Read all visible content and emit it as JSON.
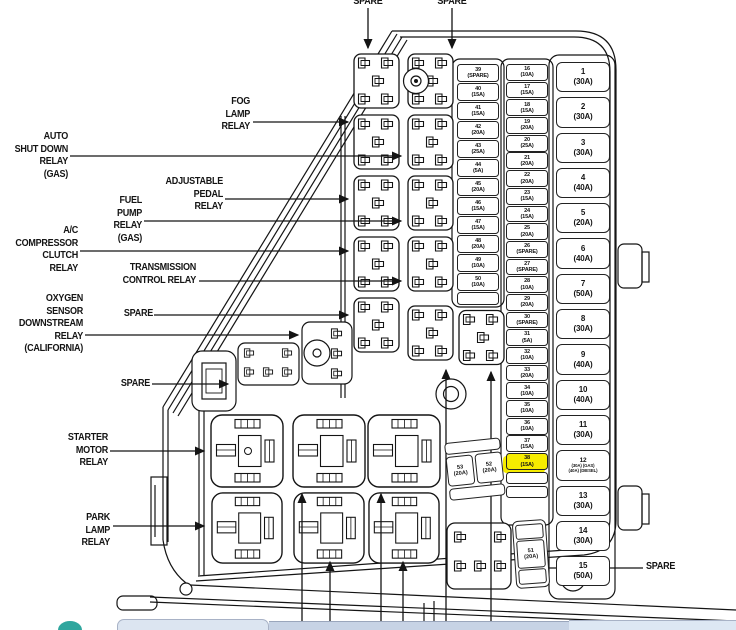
{
  "callouts": {
    "spare_top_left": "SPARE",
    "spare_top_right": "SPARE",
    "fog_lamp": "FOG\nLAMP\nRELAY",
    "auto_shutdown": "AUTO\nSHUT DOWN\nRELAY\n(GAS)",
    "adjustable_pedal": "ADJUSTABLE\nPEDAL\nRELAY",
    "fuel_pump": "FUEL\nPUMP\nRELAY\n(GAS)",
    "ac_compressor": "A/C\nCOMPRESSOR\nCLUTCH\nRELAY",
    "transmission": "TRANSMISSION\nCONTROL RELAY",
    "spare_mid_upper": "SPARE",
    "oxygen_sensor": "OXYGEN\nSENSOR\nDOWNSTREAM\nRELAY\n(CALIFORNIA)",
    "spare_mid_lower": "SPARE",
    "starter_motor": "STARTER\nMOTOR\nRELAY",
    "park_lamp": "PARK\nLAMP\nRELAY",
    "spare_bottom": "SPARE"
  },
  "highlighted_fuse": "38 (15A)",
  "highlight_color": "#f6ec00",
  "fuse_column_a": [
    {
      "n": "39",
      "a": "(SPARE)"
    },
    {
      "n": "40",
      "a": "(15A)"
    },
    {
      "n": "41",
      "a": "(15A)"
    },
    {
      "n": "42",
      "a": "(20A)"
    },
    {
      "n": "43",
      "a": "(25A)"
    },
    {
      "n": "44",
      "a": "(5A)"
    },
    {
      "n": "45",
      "a": "(20A)"
    },
    {
      "n": "46",
      "a": "(15A)"
    },
    {
      "n": "47",
      "a": "(15A)"
    },
    {
      "n": "48",
      "a": "(20A)"
    },
    {
      "n": "49",
      "a": "(10A)"
    },
    {
      "n": "50",
      "a": "(10A)"
    },
    {
      "cls": "empty"
    }
  ],
  "fuse_column_b": [
    {
      "n": "16",
      "a": "(10A)"
    },
    {
      "n": "17",
      "a": "(15A)"
    },
    {
      "n": "18",
      "a": "(15A)"
    },
    {
      "n": "19",
      "a": "(20A)"
    },
    {
      "n": "20",
      "a": "(25A)"
    },
    {
      "n": "21",
      "a": "(20A)"
    },
    {
      "n": "22",
      "a": "(20A)"
    },
    {
      "n": "23",
      "a": "(15A)"
    },
    {
      "n": "24",
      "a": "(15A)"
    },
    {
      "n": "25",
      "a": "(20A)"
    },
    {
      "n": "26",
      "a": "(SPARE)"
    },
    {
      "n": "27",
      "a": "(SPARE)"
    },
    {
      "n": "28",
      "a": "(10A)"
    },
    {
      "n": "29",
      "a": "(20A)"
    },
    {
      "n": "30",
      "a": "(SPARE)"
    },
    {
      "n": "31",
      "a": "(5A)"
    },
    {
      "n": "32",
      "a": "(10A)"
    },
    {
      "n": "33",
      "a": "(20A)"
    },
    {
      "n": "34",
      "a": "(10A)"
    },
    {
      "n": "35",
      "a": "(10A)"
    },
    {
      "n": "36",
      "a": "(10A)"
    },
    {
      "n": "37",
      "a": "(15A)"
    },
    {
      "n": "38",
      "a": "(15A)",
      "cls": "hl"
    },
    {
      "cls": "empty"
    },
    {
      "cls": "empty"
    }
  ],
  "fuse_column_right": [
    {
      "n": "1",
      "a": "(30A)"
    },
    {
      "n": "2",
      "a": "(30A)"
    },
    {
      "n": "3",
      "a": "(30A)"
    },
    {
      "n": "4",
      "a": "(40A)"
    },
    {
      "n": "5",
      "a": "(20A)"
    },
    {
      "n": "6",
      "a": "(40A)"
    },
    {
      "n": "7",
      "a": "(50A)"
    },
    {
      "n": "8",
      "a": "(30A)"
    },
    {
      "n": "9",
      "a": "(40A)"
    },
    {
      "n": "10",
      "a": "(40A)"
    },
    {
      "n": "11",
      "a": "(30A)"
    },
    {
      "n": "12",
      "a": "(30A) (GAS)",
      "b": "(40A) (DIESEL)",
      "cls": "tiny"
    },
    {
      "n": "13",
      "a": "(30A)"
    },
    {
      "n": "14",
      "a": "(30A)"
    },
    {
      "n": "15",
      "a": "(50A)"
    }
  ],
  "fuse_53": {
    "n": "53",
    "a": "(20A)"
  },
  "fuse_52": {
    "n": "52",
    "a": "(20A)"
  },
  "fuse_51": {
    "n": "51",
    "a": "(20A)"
  }
}
